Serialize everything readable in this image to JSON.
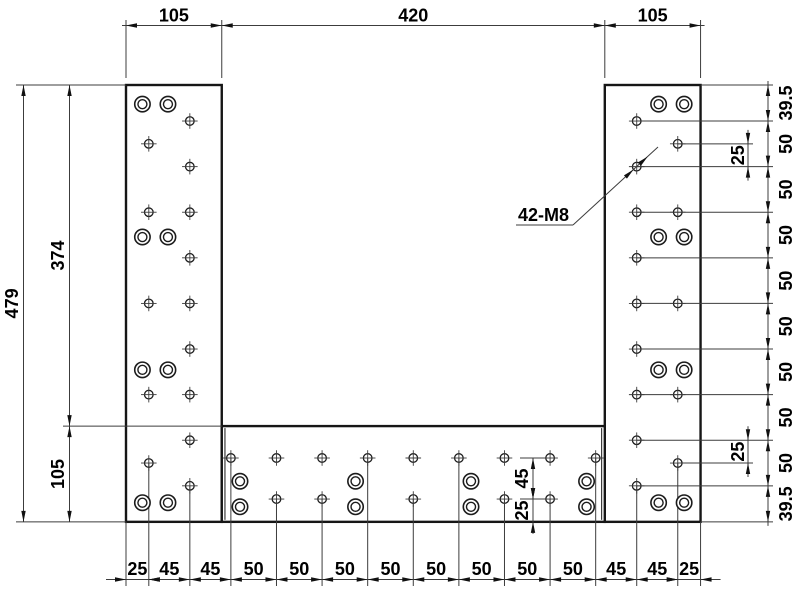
{
  "drawing": {
    "background": "#ffffff",
    "line_color": "#3c3c3c",
    "outline_color": "#161616",
    "hole_color": "#1c1c1c",
    "text_color": "#000000",
    "scale": 0.912,
    "origin": {
      "x": 126,
      "y": 85
    },
    "part": {
      "width": 630,
      "height": 479,
      "plates": [
        {
          "name": "left-plate",
          "x": 0,
          "y": 0,
          "w": 105,
          "h": 479
        },
        {
          "name": "right-plate",
          "x": 525,
          "y": 0,
          "w": 105,
          "h": 479
        },
        {
          "name": "bottom-plate",
          "x": 105,
          "y": 374,
          "w": 420,
          "h": 105
        }
      ],
      "seams": [
        {
          "x": 108.5,
          "y1": 374,
          "y2": 479
        },
        {
          "x": 521.5,
          "y1": 374,
          "y2": 479
        }
      ]
    },
    "holes": {
      "note": "42-M8",
      "tapped": {
        "left_inner_col": {
          "x": 70,
          "ys": [
            39.5,
            89.5,
            139.5,
            189.5,
            239.5,
            289.5,
            339.5,
            389.5,
            439.5
          ]
        },
        "left_outer_col": {
          "x": 25,
          "ys": [
            64.5,
            139.5,
            239.5,
            339.5,
            414.5
          ]
        },
        "right_inner_col": {
          "x": 560,
          "ys": [
            39.5,
            89.5,
            139.5,
            189.5,
            239.5,
            289.5,
            339.5,
            389.5,
            439.5
          ]
        },
        "right_outer_col": {
          "x": 605,
          "ys": [
            64.5,
            139.5,
            239.5,
            339.5,
            414.5
          ]
        },
        "bottom_top_row": {
          "y": 409,
          "xs": [
            115,
            165,
            215,
            265,
            315,
            365,
            415,
            465,
            515
          ]
        },
        "bottom_bot_row": {
          "y": 454,
          "xs": [
            165,
            215,
            315,
            415,
            465
          ]
        }
      },
      "counterbored": {
        "left_pairs": {
          "xs": [
            18,
            46
          ],
          "ys": [
            21,
            166.7,
            312.3,
            458
          ]
        },
        "right_pairs": {
          "xs": [
            584,
            612
          ],
          "ys": [
            21,
            166.7,
            312.3,
            458
          ]
        },
        "bottom_pairs": {
          "xs": [
            125,
            251.7,
            378.3,
            505
          ],
          "ys": [
            434.5,
            462.5
          ]
        }
      }
    },
    "dimensions": {
      "top_chain": {
        "line_y_px": 25.5,
        "text_y_px": 21.5,
        "ext_top_px": 20,
        "ext_from_px": 78,
        "bounds_u": [
          0,
          105,
          525,
          630
        ],
        "labels": [
          "105",
          "420",
          "105"
        ]
      },
      "bottom_chain": {
        "line_y_px": 579.5,
        "text_y_px": 575,
        "ext_bottom_px": 586,
        "bounds_u": [
          0,
          25,
          70,
          115,
          165,
          215,
          265,
          315,
          365,
          415,
          465,
          515,
          560,
          605,
          630
        ],
        "ext_from_u": [
          479,
          414.5,
          439.5,
          409,
          454,
          454,
          409,
          454,
          409,
          454,
          454,
          409,
          439.5,
          414.5,
          479
        ],
        "labels": [
          "25",
          "45",
          "45",
          "50",
          "50",
          "50",
          "50",
          "50",
          "50",
          "50",
          "50",
          "45",
          "45",
          "25"
        ]
      },
      "right_chain": {
        "line_x_px": 768,
        "text_x_px": 792,
        "ext_right_px": 773,
        "hole_col_u": 560,
        "bounds_u": [
          0,
          39.5,
          89.5,
          139.5,
          189.5,
          239.5,
          289.5,
          339.5,
          389.5,
          439.5,
          479
        ],
        "labels": [
          "39.5",
          "50",
          "50",
          "50",
          "50",
          "50",
          "50",
          "50",
          "50",
          "39.5"
        ]
      },
      "left_dims": [
        {
          "label": "479",
          "from_u": 0,
          "to_u": 479,
          "line_x_px": 23.5,
          "text_x_px": 18
        },
        {
          "label": "374",
          "from_u": 0,
          "to_u": 374,
          "line_x_px": 69.5,
          "text_x_px": 64
        },
        {
          "label": "105",
          "from_u": 374,
          "to_u": 479,
          "line_x_px": 69.5,
          "text_x_px": 64
        }
      ],
      "left_ext": [
        {
          "y_u": 0,
          "x1_px": 16,
          "x2_px": 126
        },
        {
          "y_u": 374,
          "x1_px": 63,
          "x2_px": 222
        },
        {
          "y_u": 479,
          "x1_px": 16,
          "x2_px": 126
        }
      ],
      "right_offset_dims": {
        "line_x_px": 748,
        "text_x_px": 744,
        "ext_to_px": 753,
        "outer_col_u": 605,
        "dims": [
          {
            "label": "25",
            "from_u": 64.5,
            "to_u": 89.5,
            "outer_row_u": 64.5
          },
          {
            "label": "25",
            "from_u": 389.5,
            "to_u": 414.5,
            "outer_row_u": 414.5
          }
        ]
      },
      "bottom_offset_dims": {
        "line_x_px": 533,
        "text_x_px": 528,
        "tick_x1_px": 520,
        "tick_x2_px": 546,
        "dims": [
          {
            "label": "45",
            "from_u": 409,
            "to_u": 454,
            "arrows": "inside"
          },
          {
            "label": "25",
            "from_u": 454,
            "to_u": 479,
            "arrows": "outside"
          }
        ]
      },
      "leader": {
        "label": "42-M8",
        "text_x_px": 518,
        "text_y_px": 221,
        "underline_px": [
          516,
          225,
          573,
          225
        ],
        "line_end_px": [
          658,
          147
        ],
        "target_u": {
          "x": 560,
          "y": 89.5
        }
      }
    }
  }
}
